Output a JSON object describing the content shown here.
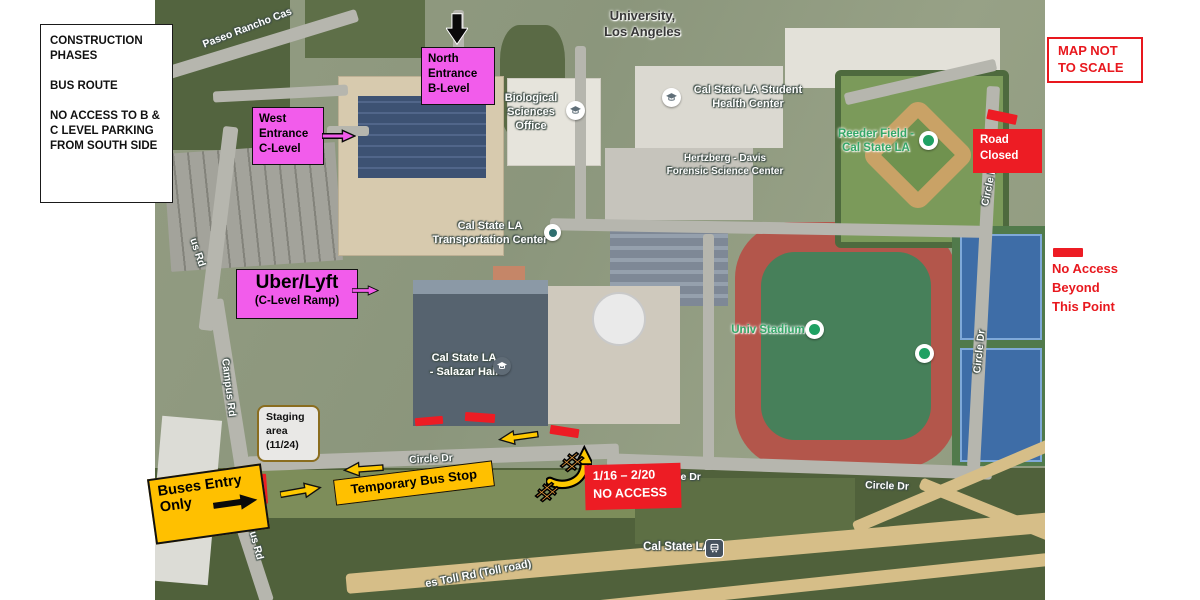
{
  "colors": {
    "magenta": "#f25ceb",
    "annotation_yellow": "#ffc000",
    "annotation_red": "#ed1c24",
    "green_map_label": "#35a768"
  },
  "side_notes": {
    "legend_text": "CONSTRUCTION PHASES\n\nBUS ROUTE\n\nNO ACCESS TO B & C LEVEL PARKING FROM SOUTH SIDE",
    "map_not_to_scale": "MAP NOT\nTO SCALE",
    "no_access_legend": "No Access\nBeyond\nThis Point"
  },
  "callouts": {
    "north_entrance": "North\nEntrance\nB-Level",
    "west_entrance": "West\nEntrance\nC-Level",
    "uber_title": "Uber/Lyft",
    "uber_sub": "(C-Level Ramp)",
    "road_closed": "Road\nClosed",
    "staging_area": "Staging\narea\n(11/24)",
    "buses_entry_line1": "Buses Entry",
    "buses_entry_line2": "Only",
    "temporary_bus_stop": "Temporary Bus Stop",
    "no_access_dates": "1/16 – 2/20",
    "no_access_label": "NO ACCESS",
    "barricade_hash": "#"
  },
  "map_labels": [
    {
      "text": "University,\nLos Angeles"
    },
    {
      "text": "Biological\nSciences\nOffice"
    },
    {
      "text": "Cal State LA Student\nHealth Center"
    },
    {
      "text": "Hertzberg - Davis\nForensic Science Center"
    },
    {
      "text": "Cal State LA\nTransportation Center"
    },
    {
      "text": "Reeder Field -\nCal State LA"
    },
    {
      "text": "Univ Stadium"
    },
    {
      "text": "Cal State LA\n- Salazar Hall"
    },
    {
      "text": "Cal State LA"
    },
    {
      "text": "Paseo Rancho Cas"
    },
    {
      "text": "us Rd"
    },
    {
      "text": "Campus Rd"
    },
    {
      "text": "Campus Rd"
    },
    {
      "text": "Circle Dr"
    },
    {
      "text": "Circle Dr"
    },
    {
      "text": "Circle Dr"
    },
    {
      "text": "Circle Dr"
    },
    {
      "text": "Circle Dr"
    },
    {
      "text": "es Toll Rd (Toll road)"
    }
  ]
}
